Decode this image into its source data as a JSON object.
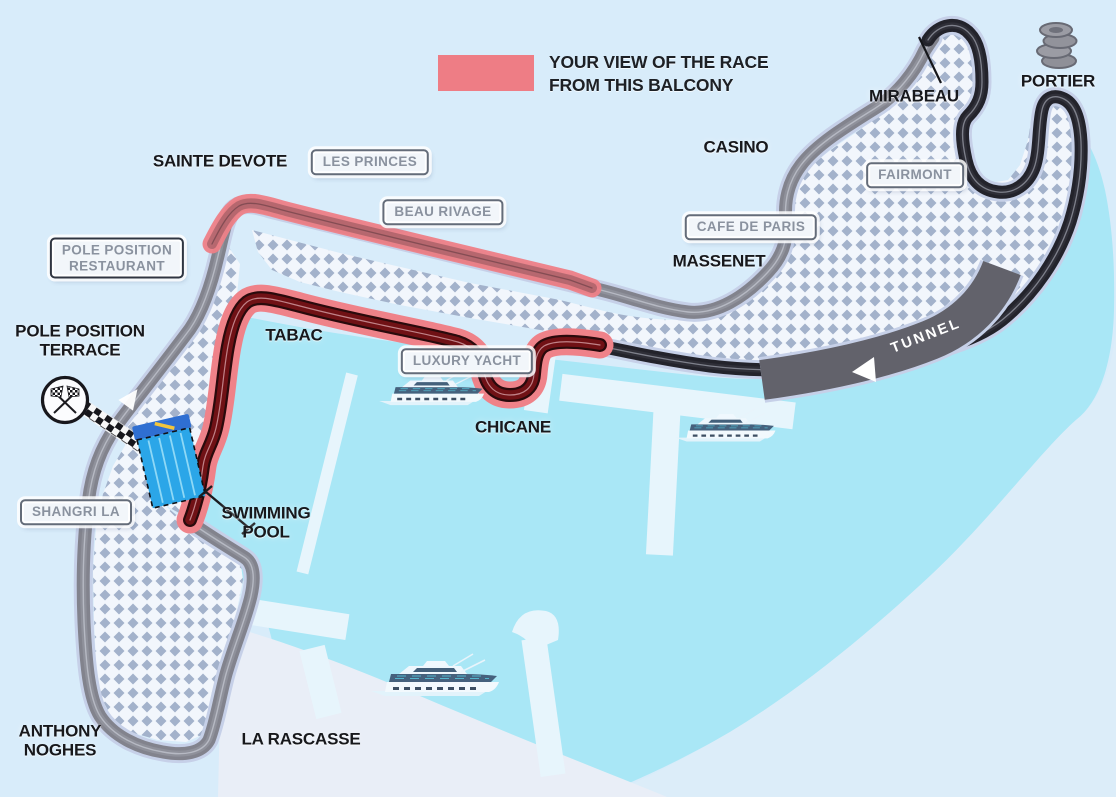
{
  "legend": {
    "line1": "YOUR VIEW OF THE RACE",
    "line2": "FROM THIS BALCONY",
    "swatch_color": "#ee7d85"
  },
  "corners": {
    "sainte_devote": "SAINTE DEVOTE",
    "casino": "CASINO",
    "massenet": "MASSENET",
    "mirabeau": "MIRABEAU",
    "portier": "PORTIER",
    "tabac": "TABAC",
    "chicane": "CHICANE",
    "la_rascasse": "LA RASCASSE",
    "anthony_noghes": [
      "ANTHONY",
      "NOGHES"
    ],
    "swimming_pool": [
      "SWIMMING",
      "POOL"
    ],
    "pole_position_terrace": [
      "POLE POSITION",
      "TERRACE"
    ],
    "tunnel": "TUNNEL"
  },
  "landmarks": {
    "les_princes": "LES PRINCES",
    "beau_rivage": "BEAU RIVAGE",
    "fairmont": "FAIRMONT",
    "cafe_de_paris": "CAFE DE PARIS",
    "luxury_yacht": "LUXURY YACHT",
    "shangri_la": "SHANGRI LA",
    "pole_position_restaurant": [
      "POLE POSITION",
      "RESTAURANT"
    ]
  },
  "icons": {
    "checkered_flags": "start-finish crossed checkered flags",
    "tire_stack": "tire stack",
    "yacht": "yacht",
    "direction_arrow": "direction arrow",
    "tunnel_arrow": "tunnel direction arrow"
  },
  "colors": {
    "background": "#d8ecfa",
    "harbor_water": "#a9e7f6",
    "view_highlight": "#ee7d85",
    "track_visible_road": "#701115",
    "track_grey_road": "#82838d",
    "track_dark_road": "#23232b",
    "tunnel_band": "#62626b",
    "pool_blue": "#2ba6e8"
  }
}
